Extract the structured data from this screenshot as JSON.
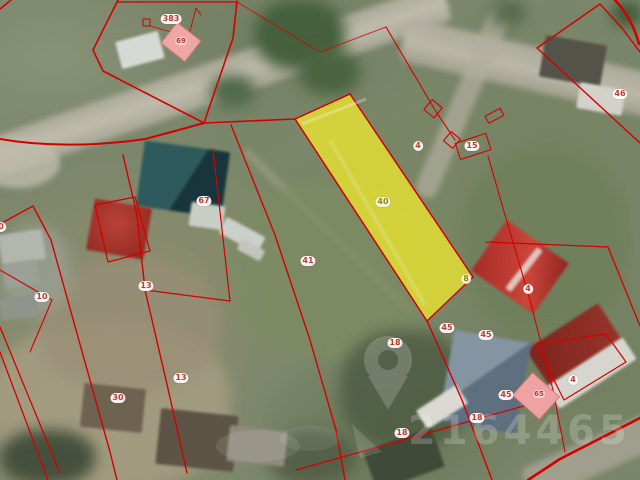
{
  "app": {
    "type": "cadastral-satellite-map-view"
  },
  "map": {
    "colors": {
      "boundary": "#d40000",
      "highlight_fill": "#e7e232",
      "label_text": "#bf3b30",
      "selected_label_text": "#8e8a10",
      "label_background": "#ffffff"
    },
    "selected_parcel": {
      "label": "40",
      "marker": "8"
    },
    "labels": [
      {
        "text": "383",
        "x": 171,
        "y": 19,
        "variant": "red"
      },
      {
        "text": "69",
        "x": 181,
        "y": 41,
        "variant": "building"
      },
      {
        "text": "46",
        "x": 620,
        "y": 94,
        "variant": "red"
      },
      {
        "text": "4",
        "x": 418,
        "y": 146,
        "variant": "red"
      },
      {
        "text": "15",
        "x": 472,
        "y": 146,
        "variant": "red"
      },
      {
        "text": "67",
        "x": 204,
        "y": 201,
        "variant": "red"
      },
      {
        "text": "40",
        "x": 383,
        "y": 202,
        "variant": "olive"
      },
      {
        "text": "0",
        "x": 1,
        "y": 227,
        "variant": "red"
      },
      {
        "text": "41",
        "x": 308,
        "y": 261,
        "variant": "red"
      },
      {
        "text": "8",
        "x": 466,
        "y": 279,
        "variant": "olive"
      },
      {
        "text": "13",
        "x": 146,
        "y": 286,
        "variant": "red"
      },
      {
        "text": "4",
        "x": 528,
        "y": 289,
        "variant": "red"
      },
      {
        "text": "10",
        "x": 42,
        "y": 297,
        "variant": "red"
      },
      {
        "text": "45",
        "x": 447,
        "y": 328,
        "variant": "red"
      },
      {
        "text": "45",
        "x": 486,
        "y": 335,
        "variant": "red"
      },
      {
        "text": "18",
        "x": 395,
        "y": 343,
        "variant": "red"
      },
      {
        "text": "13",
        "x": 181,
        "y": 378,
        "variant": "red"
      },
      {
        "text": "4",
        "x": 573,
        "y": 380,
        "variant": "red"
      },
      {
        "text": "65",
        "x": 539,
        "y": 394,
        "variant": "building"
      },
      {
        "text": "45",
        "x": 506,
        "y": 395,
        "variant": "red"
      },
      {
        "text": "30",
        "x": 118,
        "y": 398,
        "variant": "red"
      },
      {
        "text": "18",
        "x": 477,
        "y": 418,
        "variant": "red"
      },
      {
        "text": "18",
        "x": 402,
        "y": 433,
        "variant": "red"
      }
    ],
    "watermark": {
      "digits": "2164465",
      "icon": "location-pin-icon"
    }
  }
}
